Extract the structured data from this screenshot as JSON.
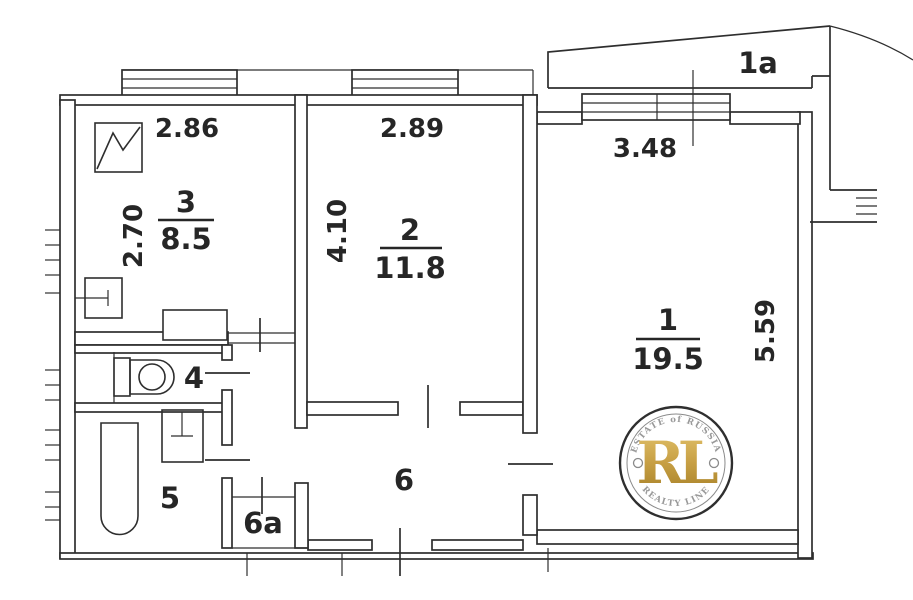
{
  "plan": {
    "title": "apartment-floor-plan",
    "rooms": {
      "r1": {
        "number": "1",
        "area": "19.5"
      },
      "r1a": {
        "number": "1a"
      },
      "r2": {
        "number": "2",
        "area": "11.8"
      },
      "r3": {
        "number": "3",
        "area": "8.5"
      },
      "r4": {
        "number": "4"
      },
      "r5": {
        "number": "5"
      },
      "r6": {
        "number": "6"
      },
      "r6a": {
        "number": "6a"
      }
    },
    "dimensions": {
      "room3_width": "2.86",
      "room3_depth": "2.70",
      "room2_width": "2.89",
      "room2_depth": "4.10",
      "room1_width": "3.48",
      "room1_depth": "5.59"
    }
  },
  "watermark": {
    "monogram": "RL",
    "arc_top": "ESTATE of RUSSIA",
    "arc_bottom": "REALTY LINE",
    "gold": "#c39a3f",
    "ring_color": "#2f2f2f",
    "text_color": "#999999"
  },
  "colors": {
    "line": "#2e2e2e",
    "background": "#ffffff"
  }
}
